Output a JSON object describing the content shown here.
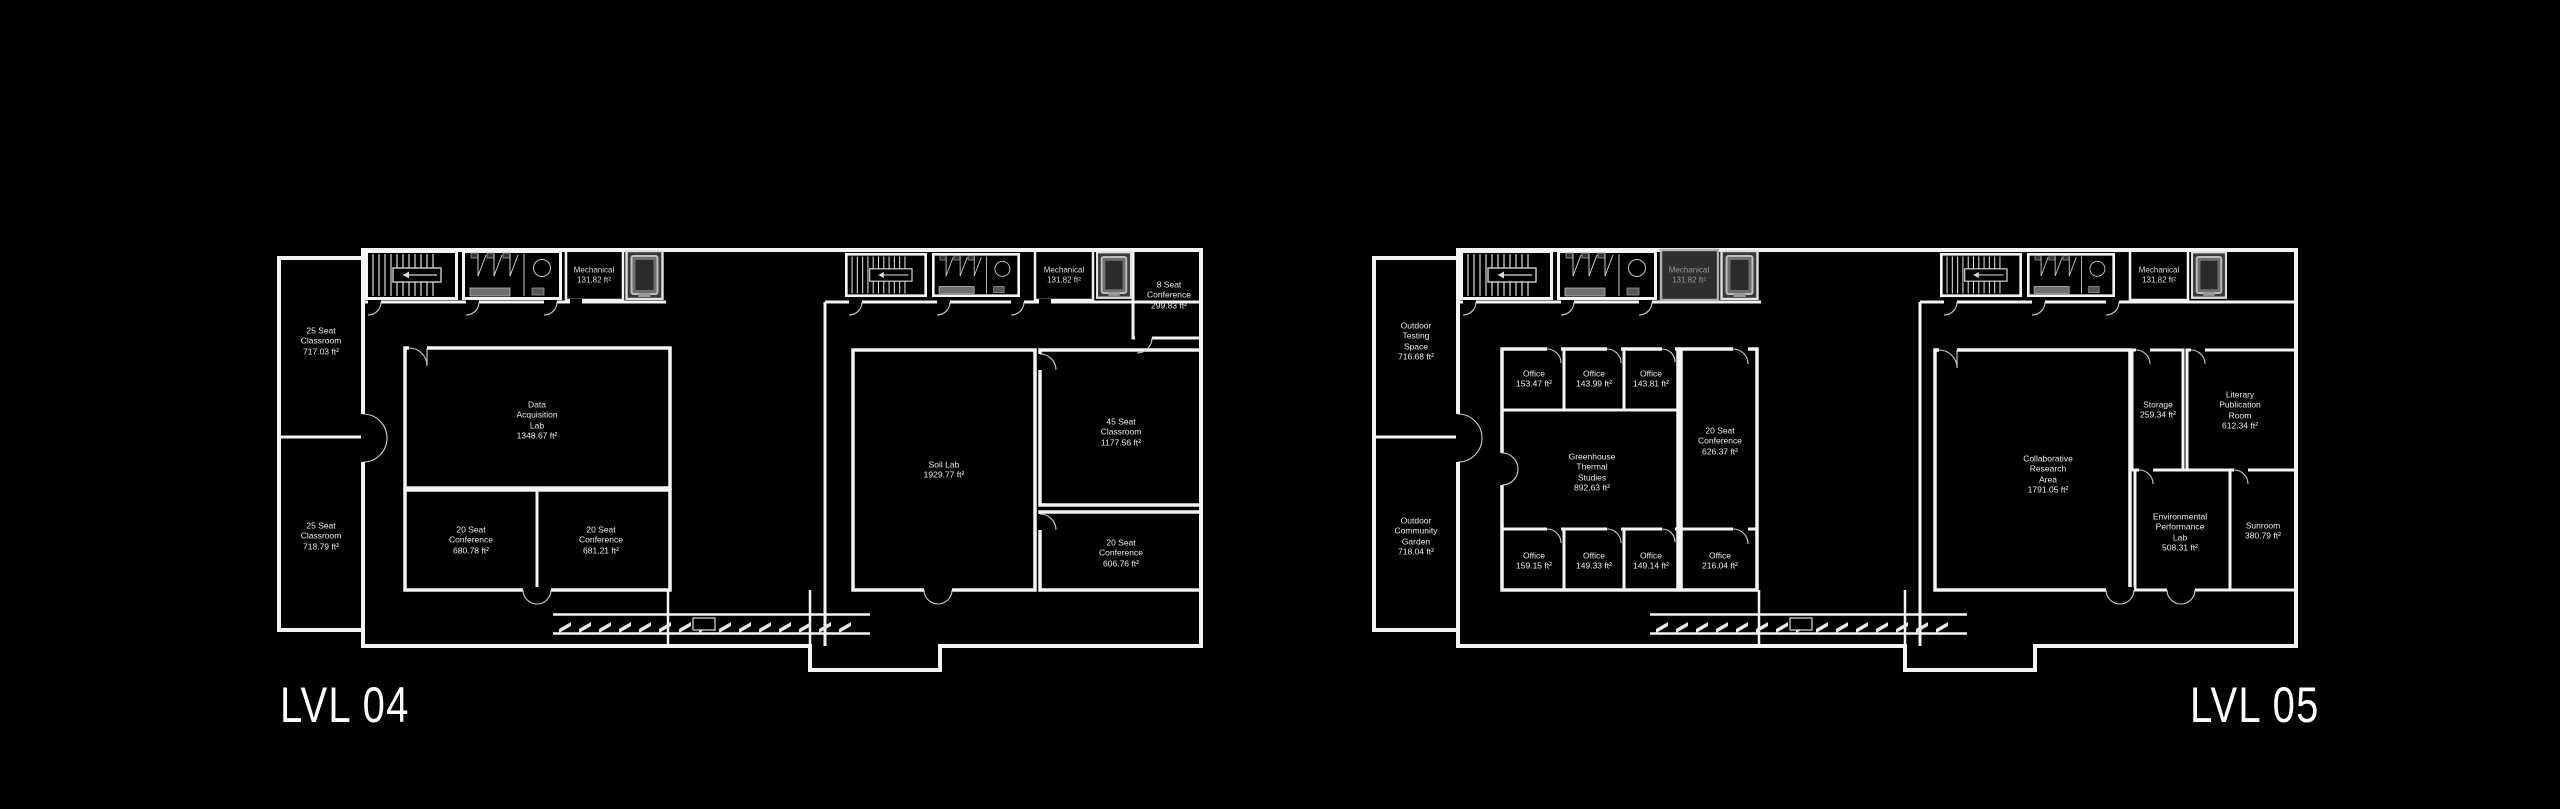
{
  "colors": {
    "background": "#000000",
    "walls": "#f4f4f4",
    "dimmed_text": "#969696",
    "elevator_fill": "#3a3a3a",
    "mechanical_dim_fill": "#2e2e2e"
  },
  "plans": [
    {
      "label": "LVL 04",
      "rooms": {
        "classroom_nw": {
          "name": "25 Seat\nClassroom",
          "area": "717.03 ft²"
        },
        "classroom_sw": {
          "name": "25 Seat\nClassroom",
          "area": "718.79 ft²"
        },
        "data_acquisition_lab": {
          "name": "Data\nAcquisition\nLab",
          "area": "1348.67 ft²"
        },
        "conference_w": {
          "name": "20 Seat\nConference",
          "area": "680.78 ft²"
        },
        "conference_e": {
          "name": "20 Seat\nConference",
          "area": "681.21 ft²"
        },
        "soil_lab": {
          "name": "Soil Lab",
          "area": "1929.77 ft²"
        },
        "classroom_45": {
          "name": "45 Seat\nClassroom",
          "area": "1177.56 ft²"
        },
        "conference_se": {
          "name": "20 Seat\nConference",
          "area": "606.76 ft²"
        },
        "conference_8": {
          "name": "8 Seat\nConference",
          "area": "299.83 ft²"
        },
        "mechanical_left": {
          "name": "Mechanical",
          "area": "131.82 ft²"
        },
        "mechanical_right": {
          "name": "Mechanical",
          "area": "131.82 ft²"
        }
      }
    },
    {
      "label": "LVL 05",
      "rooms": {
        "outdoor_testing": {
          "name": "Outdoor\nTesting\nSpace",
          "area": "716.68 ft²"
        },
        "outdoor_garden": {
          "name": "Outdoor\nCommunity\nGarden",
          "area": "718.04 ft²"
        },
        "office_1": {
          "name": "Office",
          "area": "153.47 ft²"
        },
        "office_2": {
          "name": "Office",
          "area": "143.99 ft²"
        },
        "office_3": {
          "name": "Office",
          "area": "143.81 ft²"
        },
        "greenhouse": {
          "name": "Greenhouse\nThermal\nStudies",
          "area": "892.63 ft²"
        },
        "conference_20": {
          "name": "20 Seat\nConference",
          "area": "626.37 ft²"
        },
        "office_4": {
          "name": "Office",
          "area": "159.15 ft²"
        },
        "office_5": {
          "name": "Office",
          "area": "149.33 ft²"
        },
        "office_6": {
          "name": "Office",
          "area": "149.14 ft²"
        },
        "office_7": {
          "name": "Office",
          "area": "216.04 ft²"
        },
        "collaborative": {
          "name": "Collaborative\nResearch\nArea",
          "area": "1791.05 ft²"
        },
        "storage": {
          "name": "Storage",
          "area": "259.34 ft²"
        },
        "literary": {
          "name": "Literary\nPublication\nRoom",
          "area": "612.34 ft²"
        },
        "env_lab": {
          "name": "Environmental\nPerformance\nLab",
          "area": "508.31 ft²"
        },
        "sunroom": {
          "name": "Sunroom",
          "area": "380.79 ft²"
        },
        "mechanical_left": {
          "name": "Mechanical",
          "area": "131.82 ft²"
        },
        "mechanical_right": {
          "name": "Mechanical",
          "area": "131.82 ft²"
        }
      }
    }
  ]
}
